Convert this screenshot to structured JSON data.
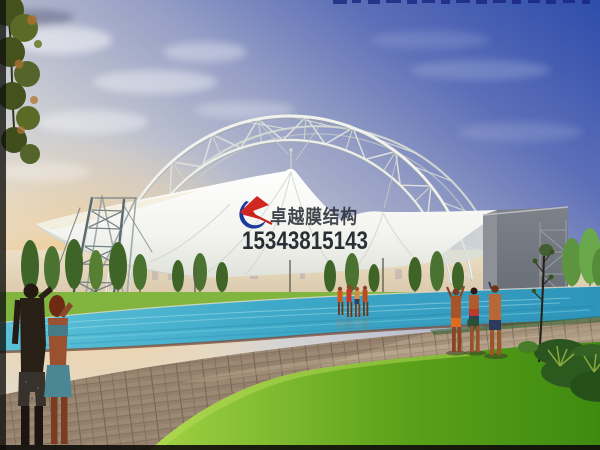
{
  "watermark": {
    "company_name": "卓越膜结构",
    "phone_number": "15343815143",
    "company_color": "#2a2e36",
    "phone_color": "#1b1f26",
    "logo": {
      "name": "zhuoyue-membrane-logo",
      "red": "#d02820",
      "blue": "#1e3a9e"
    }
  },
  "palette": {
    "sky_top": "#2d4cab",
    "sky_mid": "#97a0c6",
    "sky_pale": "#e2ddd4",
    "sunset_glow": "#f6d9a2",
    "membrane_white": "#fafaf6",
    "truss_light": "#eceee9",
    "wall_gray": "#70757c",
    "pool_blue": "#3fa9c9",
    "lawn_green": "#64b01e",
    "paver_tan": "#a5907a",
    "foliage_green": "#3f6428"
  }
}
